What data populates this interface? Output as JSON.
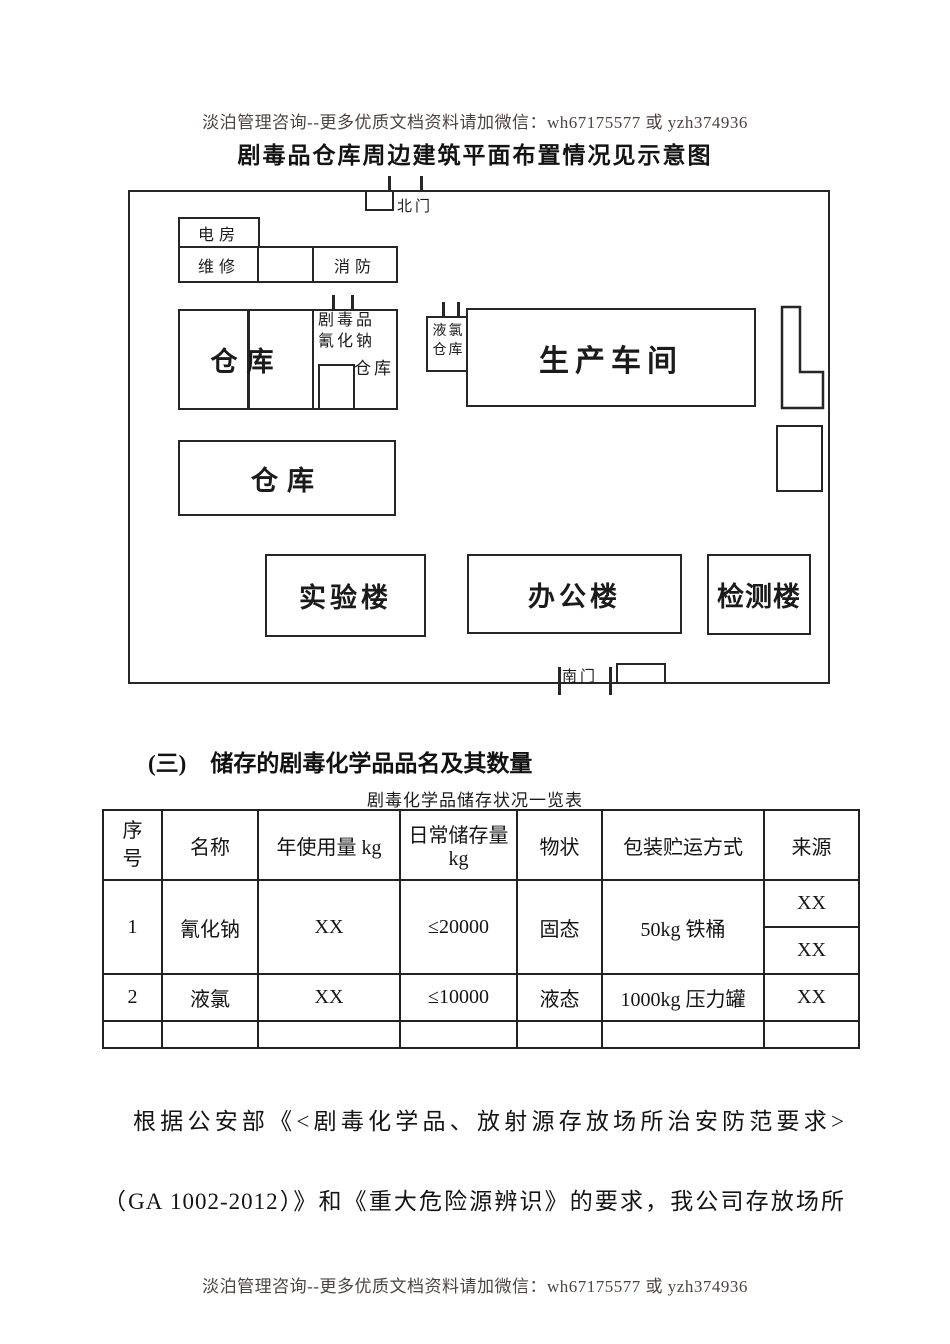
{
  "colors": {
    "note_text": "#4d4340",
    "ink": "#1b1b1b",
    "line": "#262626"
  },
  "header": {
    "note": "淡泊管理咨询--更多优质文档资料请加微信：wh67175577 或 yzh374936"
  },
  "title": "剧毒品仓库周边建筑平面布置情况见示意图",
  "diagram": {
    "north_gate": "北门",
    "south_gate": "南门",
    "electric_room": "电房",
    "maintenance": "维修",
    "fire_station": "消防",
    "warehouse_1": "仓库",
    "toxic_store_line1": "剧毒品",
    "toxic_store_line2": "氰化钠",
    "toxic_store_line3": "仓库",
    "chlorine_line1": "液氯",
    "chlorine_line2": "仓库",
    "production_workshop": "生产车间",
    "warehouse_2": "仓库",
    "lab_building": "实验楼",
    "office_building": "办公楼",
    "testing_building": "检测楼"
  },
  "section": {
    "number": "(三)",
    "heading": "储存的剧毒化学品品名及其数量",
    "table_caption": "剧毒化学品储存状况一览表"
  },
  "table": {
    "headers": [
      "序号",
      "名称",
      "年使用量 kg",
      "日常储存量 kg",
      "物状",
      "包装贮运方式",
      "来源"
    ],
    "row1": {
      "no": "1",
      "name": "氰化钠",
      "annual": "XX",
      "daily": "≤20000",
      "state": "固态",
      "package": "50kg 铁桶",
      "source_top": "XX",
      "source_bottom": "XX"
    },
    "row2": {
      "no": "2",
      "name": "液氯",
      "annual": "XX",
      "daily": "≤10000",
      "state": "液态",
      "package": "1000kg 压力罐",
      "source": "XX"
    }
  },
  "paragraph": {
    "line1": "根据公安部《<剧毒化学品、放射源存放场所治安防范要求>",
    "line2": "（GA 1002-2012）》和《重大危险源辨识》的要求，我公司存放场所"
  },
  "footer": {
    "note": "淡泊管理咨询--更多优质文档资料请加微信：wh67175577 或 yzh374936"
  }
}
